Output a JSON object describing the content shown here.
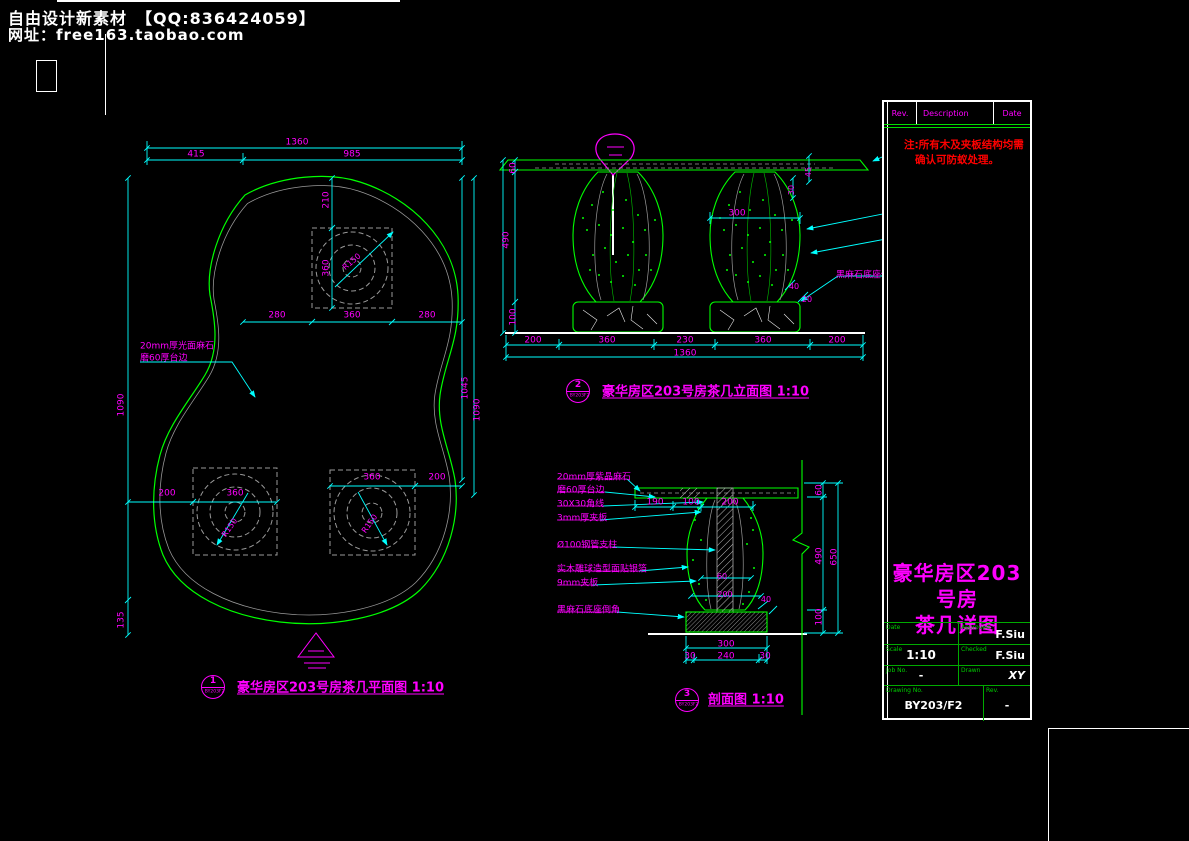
{
  "colors": {
    "background": "#000000",
    "outline_green": "#00ff00",
    "dimension_cyan": "#00ffff",
    "text_magenta": "#ff00ff",
    "note_red": "#ff0000",
    "white": "#ffffff",
    "aux_gray": "#9a9a9a"
  },
  "header": {
    "line1": "自由设计新素材　【QQ:836424059】",
    "line2": "网址：free163.taobao.com"
  },
  "plan": {
    "bubble": {
      "number": "1",
      "code": "BY203F2"
    },
    "labels": [
      {
        "t": "1360",
        "x": 297,
        "y": 143
      },
      {
        "t": "415",
        "x": 196,
        "y": 155
      },
      {
        "t": "985",
        "x": 352,
        "y": 155
      },
      {
        "t": "210",
        "x": 327,
        "y": 200,
        "r": -90
      },
      {
        "t": "360",
        "x": 327,
        "y": 268,
        "r": -90
      },
      {
        "t": "280",
        "x": 277,
        "y": 316
      },
      {
        "t": "360",
        "x": 352,
        "y": 316
      },
      {
        "t": "280",
        "x": 427,
        "y": 316
      },
      {
        "t": "1090",
        "x": 122,
        "y": 405,
        "r": -90
      },
      {
        "t": "135",
        "x": 122,
        "y": 620,
        "r": -90
      },
      {
        "t": "1045",
        "x": 466,
        "y": 388,
        "r": -90
      },
      {
        "t": "1090",
        "x": 478,
        "y": 410,
        "r": -90
      },
      {
        "t": "200",
        "x": 167,
        "y": 494
      },
      {
        "t": "360",
        "x": 235,
        "y": 494
      },
      {
        "t": "360",
        "x": 372,
        "y": 478
      },
      {
        "t": "200",
        "x": 437,
        "y": 478
      },
      {
        "t": "R150",
        "x": 352,
        "y": 262,
        "r": -40,
        "s": 8
      },
      {
        "t": "R150",
        "x": 230,
        "y": 528,
        "r": -55,
        "s": 8
      },
      {
        "t": "R150",
        "x": 370,
        "y": 524,
        "r": -55,
        "s": 8
      },
      {
        "t": "20mm厚光面麻石",
        "x": 140,
        "y": 347,
        "a": "l"
      },
      {
        "t": "磨60厚台边",
        "x": 140,
        "y": 359,
        "a": "l"
      },
      {
        "t": "豪华房区203号房茶几平面图 1:10",
        "x": 237,
        "y": 688,
        "a": "l",
        "c": "cap"
      }
    ]
  },
  "elevation": {
    "bubble": {
      "number": "2",
      "code": "BY203F2"
    },
    "labels": [
      {
        "t": "60",
        "x": 514,
        "y": 168,
        "r": -90
      },
      {
        "t": "490",
        "x": 507,
        "y": 240,
        "r": -90
      },
      {
        "t": "100",
        "x": 514,
        "y": 317,
        "r": -90
      },
      {
        "t": "200",
        "x": 533,
        "y": 341
      },
      {
        "t": "360",
        "x": 607,
        "y": 341
      },
      {
        "t": "230",
        "x": 685,
        "y": 341
      },
      {
        "t": "360",
        "x": 763,
        "y": 341
      },
      {
        "t": "200",
        "x": 837,
        "y": 341
      },
      {
        "t": "1360",
        "x": 685,
        "y": 354
      },
      {
        "t": "45",
        "x": 809,
        "y": 172,
        "r": -90,
        "s": 8
      },
      {
        "t": "30",
        "x": 792,
        "y": 190,
        "r": -90,
        "s": 8
      },
      {
        "t": "300",
        "x": 737,
        "y": 214
      },
      {
        "t": "40",
        "x": 794,
        "y": 287,
        "s": 8
      },
      {
        "t": "20",
        "x": 807,
        "y": 300,
        "s": 8
      },
      {
        "t": "20mm厚光面麻石台面",
        "x": 901,
        "y": 140,
        "a": "l"
      },
      {
        "t": "实木雕球造型面贴银箔",
        "x": 901,
        "y": 207,
        "a": "l"
      },
      {
        "t": "预留孔Ø9mm-6mm",
        "x": 901,
        "y": 233,
        "a": "l"
      },
      {
        "t": "黑麻石底座倒角",
        "x": 836,
        "y": 276,
        "a": "l"
      },
      {
        "t": "豪华房区203号房茶几立面图 1:10",
        "x": 602,
        "y": 392,
        "a": "l",
        "c": "cap"
      }
    ]
  },
  "section": {
    "bubble": {
      "number": "3",
      "code": "BY203F2"
    },
    "labels": [
      {
        "t": "190",
        "x": 655,
        "y": 503
      },
      {
        "t": "100",
        "x": 691,
        "y": 503
      },
      {
        "t": "200",
        "x": 730,
        "y": 503
      },
      {
        "t": "60",
        "x": 722,
        "y": 577,
        "s": 8
      },
      {
        "t": "200",
        "x": 725,
        "y": 595,
        "s": 8
      },
      {
        "t": "40",
        "x": 766,
        "y": 600,
        "s": 8
      },
      {
        "t": "300",
        "x": 726,
        "y": 645
      },
      {
        "t": "30",
        "x": 690,
        "y": 657
      },
      {
        "t": "240",
        "x": 726,
        "y": 657
      },
      {
        "t": "30",
        "x": 765,
        "y": 657
      },
      {
        "t": "60",
        "x": 820,
        "y": 490,
        "r": -90
      },
      {
        "t": "490",
        "x": 820,
        "y": 556,
        "r": -90
      },
      {
        "t": "100",
        "x": 820,
        "y": 617,
        "r": -90
      },
      {
        "t": "650",
        "x": 835,
        "y": 557,
        "r": -90
      },
      {
        "t": "20mm厚紫晶麻石",
        "x": 557,
        "y": 478,
        "a": "l"
      },
      {
        "t": "磨60厚台边",
        "x": 557,
        "y": 491,
        "a": "l"
      },
      {
        "t": "30X30角线",
        "x": 557,
        "y": 505,
        "a": "l"
      },
      {
        "t": "3mm厚夹板",
        "x": 557,
        "y": 519,
        "a": "l"
      },
      {
        "t": "Ø100钢管支柱",
        "x": 557,
        "y": 546,
        "a": "l"
      },
      {
        "t": "实木雕球造型面贴银箔",
        "x": 557,
        "y": 570,
        "a": "l"
      },
      {
        "t": "9mm夹板",
        "x": 557,
        "y": 584,
        "a": "l"
      },
      {
        "t": "黑麻石底座倒角",
        "x": 557,
        "y": 611,
        "a": "l"
      },
      {
        "t": "剖面图 1:10",
        "x": 708,
        "y": 700,
        "a": "l",
        "c": "cap"
      }
    ]
  },
  "titleblock": {
    "header": {
      "rev": "Rev.",
      "description": "Description",
      "date": "Date"
    },
    "note_line1": "注:所有木及夹板结构均需",
    "note_line2": "确认可防蚁处理。",
    "title_line1": "豪华房区203号房",
    "title_line2": "茶几详图",
    "fields": {
      "date_label": "Date",
      "date_value": "",
      "approved_label": "Approved",
      "approved_value": "F.Siu",
      "scale_label": "Scale",
      "scale_value": "1:10",
      "checked_label": "Checked",
      "checked_value": "F.Siu",
      "job_label": "Job No.",
      "job_value": "-",
      "drawn_label": "Drawn",
      "drawn_value": "XY",
      "dwg_label": "Drawing No.",
      "dwg_value": "BY203/F2",
      "rev_label": "Rev.",
      "rev_value": "-"
    }
  }
}
